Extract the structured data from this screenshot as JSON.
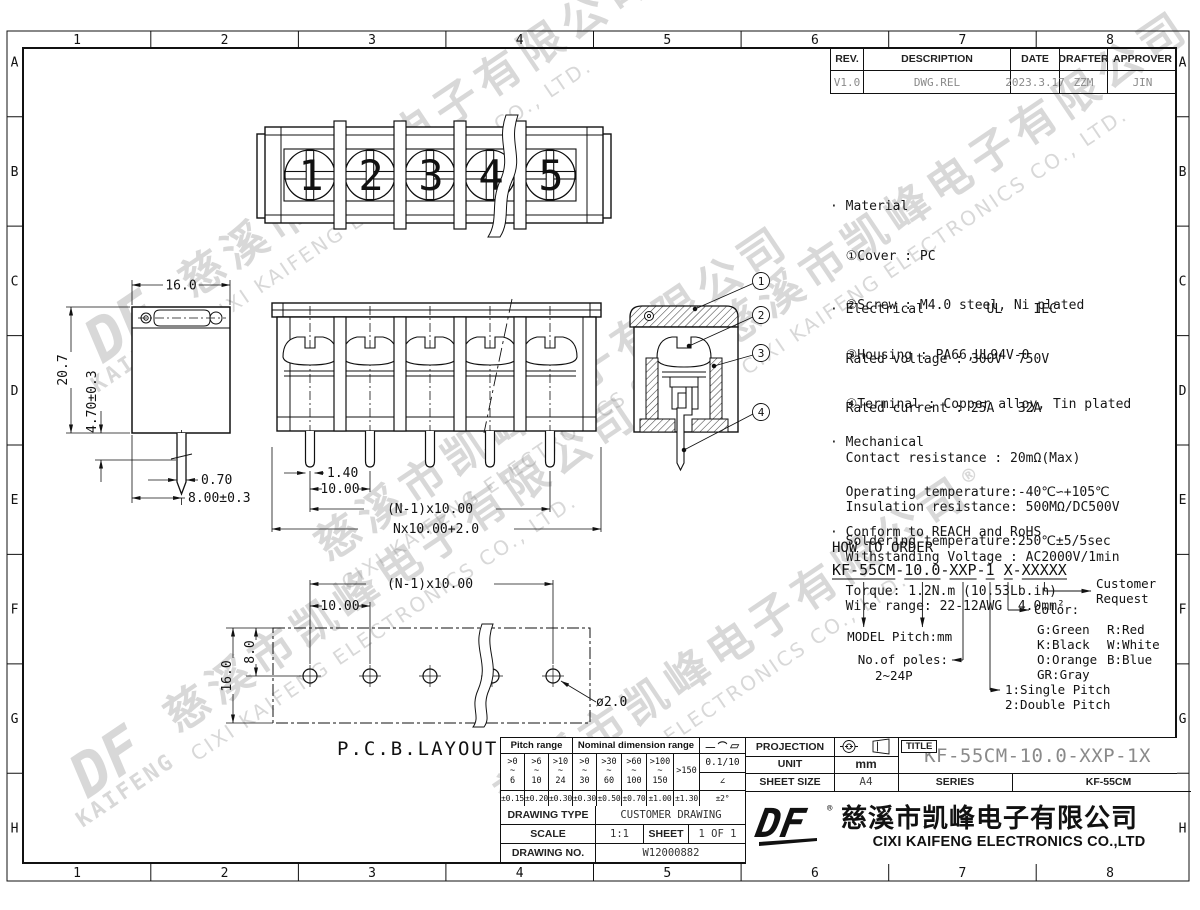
{
  "grid": {
    "cols": [
      "1",
      "2",
      "3",
      "4",
      "5",
      "6",
      "7",
      "8"
    ],
    "rows": [
      "A",
      "B",
      "C",
      "D",
      "E",
      "F",
      "G",
      "H"
    ]
  },
  "revision_table": {
    "headers": [
      "REV.",
      "DESCRIPTION",
      "DATE",
      "DRAFTER",
      "APPROVER"
    ],
    "row": [
      "V1.0",
      "DWG.REL",
      "2023.3.17",
      "ZZM",
      "JIN"
    ]
  },
  "specs": {
    "material_lines": [
      "· Material",
      "  ①Cover : PC",
      "  ②Screw : M4.0 steel, Ni plated",
      "  ③Housing : PA66,UL94V-0",
      "  ④Terminal : Copper alloy, Tin plated"
    ],
    "electrical_lines": [
      "· Electrical        UL    IEC",
      "  Rated voltage : 300V  750V",
      "  Rated current : 25A   32A",
      "  Contact resistance : 20mΩ(Max)",
      "  Insulation resistance: 500MΩ/DC500V",
      "  Withstanding Voltage : AC2000V/1min",
      "  Wire range: 22-12AWG  4.0mm²"
    ],
    "mechanical_lines": [
      "· Mechanical",
      "  Operating temperature:-40℃∽+105℃",
      "  Soldering temperature:250℃±5/5sec",
      "  Torque: 1.2N.m (10.53Lb.in)"
    ],
    "conform_line": "· Conform to REACH and RoHS"
  },
  "how_to_order": {
    "title": "HOW TO ORDER",
    "code": "KF-55CM-10.0-XXP-1 X-XXXXX",
    "model_label": "MODEL",
    "pitch_label": "Pitch:mm",
    "poles_label": "No.of poles:",
    "poles_value": "2~24P",
    "pitch_opt1": "1:Single Pitch",
    "pitch_opt2": "2:Double Pitch",
    "color_label": "Color:",
    "colors_col1": [
      "G:Green",
      "K:Black",
      "O:Orange",
      "GR:Gray"
    ],
    "colors_col2": [
      "R:Red",
      "W:White",
      "B:Blue"
    ],
    "customer_line1": "Customer",
    "customer_line2": "Request"
  },
  "views": {
    "top": {
      "screw_numbers": [
        "1",
        "2",
        "3",
        "4",
        "5"
      ]
    },
    "section": {
      "balloons": [
        "1",
        "2",
        "3",
        "4"
      ]
    },
    "side_dims": {
      "width": "16.0",
      "height": "20.7",
      "pin_depth": "4.70±0.3",
      "pin_width": "0.70",
      "pin_offset": "8.00±0.3"
    },
    "front_dims": {
      "pin_w": "1.40",
      "pitch": "10.00",
      "span": "(N-1)x10.00",
      "total": "Nx10.00+2.0"
    },
    "pcb": {
      "span": "(N-1)x10.00",
      "pitch": "10.00",
      "row_offset": "8.0",
      "depth": "16.0",
      "hole_dia": "ø2.0",
      "label": "P.C.B.LAYOUT"
    }
  },
  "tolerance_table": {
    "pitch_header": "Pitch range",
    "nominal_header": "Nominal dimension range",
    "symbols_header": "— ⌒ ▱",
    "ranges": [
      ">0\n~\n6",
      ">6\n~\n10",
      ">10\n~\n24",
      ">0\n~\n30",
      ">30\n~\n60",
      ">60\n~\n100",
      ">100\n~\n150",
      ">150"
    ],
    "tolerances": [
      "±0.15",
      "±0.20",
      "±0.30",
      "±0.30",
      "±0.50",
      "±0.70",
      "±1.00",
      "±1.30"
    ],
    "flatness": "0.1/10",
    "angle_symbol": "∠",
    "angle_tolerance": "±2°"
  },
  "title_block": {
    "projection_label": "PROJECTION",
    "title_label": "TITLE",
    "title_value": "KF-55CM-10.0-XXP-1X",
    "unit_label": "UNIT",
    "unit_value": "mm",
    "sheet_size_label": "SHEET SIZE",
    "sheet_size_value": "A4",
    "series_label": "SERIES",
    "series_value": "KF-55CM",
    "drawing_type_label": "DRAWING TYPE",
    "drawing_type_value": "CUSTOMER DRAWING",
    "scale_label": "SCALE",
    "scale_value": "1:1",
    "sheet_label": "SHEET",
    "sheet_value": "1 OF 1",
    "drawing_no_label": "DRAWING NO.",
    "drawing_no_value": "W12000882"
  },
  "company": {
    "logo_text": "DF",
    "registered": "®",
    "name_cn": "慈溪市凯峰电子有限公司",
    "name_en": "CIXI KAIFENG ELECTRONICS CO.,LTD"
  },
  "watermark": {
    "logo_top": "DF",
    "logo_sub": "KAIFENG",
    "registered": "®",
    "cn": "慈溪市凯峰电子有限公司",
    "en": "CIXI KAIFENG ELECTRONICS CO., LTD."
  }
}
